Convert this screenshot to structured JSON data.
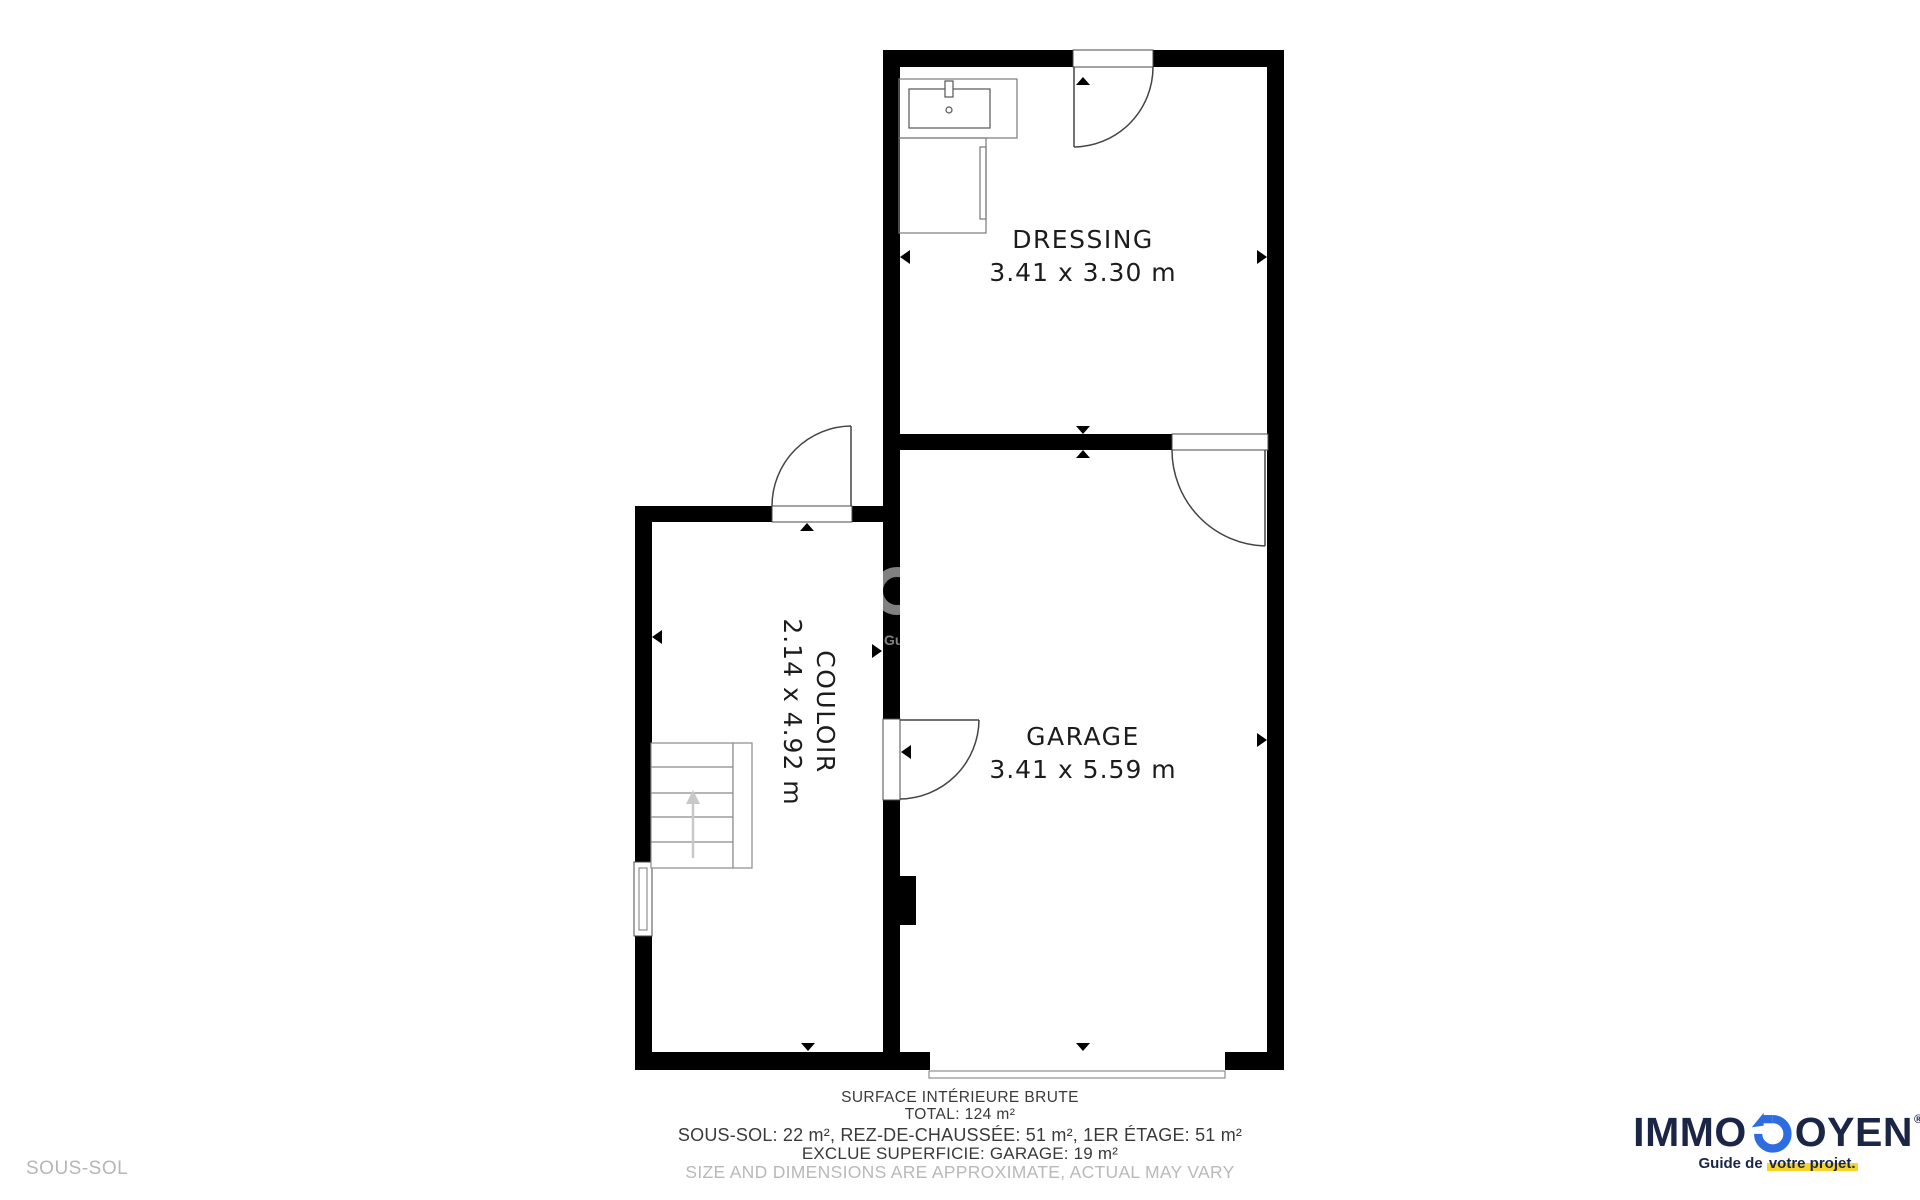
{
  "floor_label": "SOUS-SOL",
  "rooms": [
    {
      "name": "DRESSING",
      "dims": "3.41 x 3.30 m"
    },
    {
      "name": "GARAGE",
      "dims": "3.41 x 5.59 m"
    },
    {
      "name": "COULOIR",
      "dims": "2.14 x 4.92 m"
    }
  ],
  "footer": {
    "line1": "SURFACE INTÉRIEURE BRUTE",
    "line2": "TOTAL: 124 m²",
    "line3": "SOUS-SOL: 22 m², REZ-DE-CHAUSSÉE: 51 m², 1ER ÉTAGE: 51 m²",
    "line4": "EXCLUE SUPERFICIE: GARAGE: 19 m²",
    "line5": "SIZE AND DIMENSIONS ARE APPROXIMATE, ACTUAL MAY VARY"
  },
  "logo": {
    "part1": "IMMO",
    "part2": "OYEN",
    "reg": "®",
    "tagline_prefix": "Guide de ",
    "tagline_highlight": "votre projet."
  },
  "watermark_tagline": "Guide de votre projet.",
  "colors": {
    "wall": "#000000",
    "outline_dark": "#4a4a4a",
    "outline_gray": "#7a7a7a",
    "brand_navy": "#1b2546",
    "brand_blue": "#2e6ce2",
    "highlight_yellow": "#f6d42b",
    "muted_text": "#b9b9b9"
  }
}
